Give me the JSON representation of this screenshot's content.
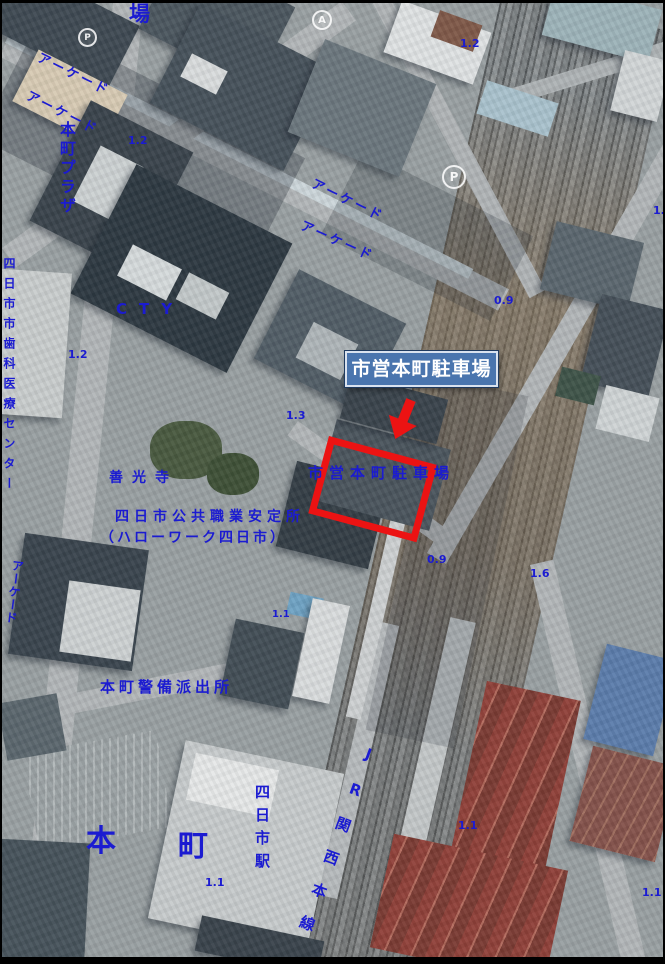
{
  "colors": {
    "label_blue": "#1b1bd1",
    "highlight_red": "#ec1313",
    "callout_bg": "#4a75ae",
    "callout_border": "#d9e2ef",
    "callout_text": "#ffffff"
  },
  "callout": {
    "label": "市営本町駐車場"
  },
  "map_labels": [
    {
      "text": "場",
      "x": 127,
      "y": 1,
      "size": 21
    },
    {
      "text": "アーケード",
      "x": 36,
      "y": 48,
      "size": 13,
      "spacing": 3,
      "rotate": 26
    },
    {
      "text": "アーケード",
      "x": 25,
      "y": 86,
      "size": 13,
      "spacing": 3,
      "rotate": 27
    },
    {
      "text": "本町プラザ",
      "x": 56,
      "y": 118,
      "size": 16,
      "spacing": 3,
      "vertical": true
    },
    {
      "text": "1.2",
      "x": 126,
      "y": 132,
      "size": 11
    },
    {
      "text": "1.2",
      "x": 458,
      "y": 35,
      "size": 11
    },
    {
      "text": "アーケード",
      "x": 310,
      "y": 174,
      "size": 13,
      "spacing": 3,
      "rotate": 26
    },
    {
      "text": "アーケード",
      "x": 299,
      "y": 216,
      "size": 13,
      "spacing": 3,
      "rotate": 24
    },
    {
      "text": "1.",
      "x": 651,
      "y": 202,
      "size": 11
    },
    {
      "text": "四日市市歯科医療センター",
      "x": 1,
      "y": 254,
      "size": 12,
      "spacing": 8,
      "vertical": true
    },
    {
      "text": "CTY",
      "x": 114,
      "y": 299,
      "size": 15,
      "spacing": 12
    },
    {
      "text": "1.2",
      "x": 66,
      "y": 346,
      "size": 11
    },
    {
      "text": "1.3",
      "x": 284,
      "y": 407,
      "size": 11
    },
    {
      "text": "0.9",
      "x": 492,
      "y": 292,
      "size": 11
    },
    {
      "text": "市営本町駐車場",
      "x": 306,
      "y": 463,
      "size": 15,
      "spacing": 6
    },
    {
      "text": "善光寺",
      "x": 107,
      "y": 468,
      "size": 14,
      "spacing": 9
    },
    {
      "text": "四日市公共職業安定所",
      "x": 113,
      "y": 507,
      "size": 14,
      "spacing": 5
    },
    {
      "text": "（ハローワーク四日市）",
      "x": 98,
      "y": 528,
      "size": 14,
      "spacing": 3
    },
    {
      "text": "0.9",
      "x": 425,
      "y": 551,
      "size": 11
    },
    {
      "text": "1.6",
      "x": 528,
      "y": 565,
      "size": 11
    },
    {
      "text": "アーケード",
      "x": 10,
      "y": 556,
      "size": 12,
      "spacing": 1,
      "vertical": true,
      "rotate": 7
    },
    {
      "text": "1.1",
      "x": 270,
      "y": 607,
      "size": 10
    },
    {
      "text": "本町警備派出所",
      "x": 98,
      "y": 677,
      "size": 15,
      "spacing": 4
    },
    {
      "text": "JR関西本線",
      "x": 362,
      "y": 740,
      "size": 15,
      "spacing": 20,
      "vertical": true,
      "rotate": 20
    },
    {
      "text": "四日市駅",
      "x": 252,
      "y": 781,
      "size": 15,
      "spacing": 8,
      "vertical": true
    },
    {
      "text": "本",
      "x": 84,
      "y": 824,
      "size": 30
    },
    {
      "text": "町",
      "x": 176,
      "y": 829,
      "size": 30
    },
    {
      "text": "1.1",
      "x": 456,
      "y": 817,
      "size": 11
    },
    {
      "text": "1.1",
      "x": 203,
      "y": 874,
      "size": 11
    },
    {
      "text": "1.1",
      "x": 640,
      "y": 884,
      "size": 11
    }
  ],
  "ground_marks": [
    {
      "glyph": "P",
      "x": 440,
      "y": 162,
      "d": 20
    },
    {
      "glyph": "A",
      "x": 310,
      "y": 7,
      "d": 16
    },
    {
      "glyph": "P",
      "x": 76,
      "y": 25,
      "d": 15
    }
  ]
}
